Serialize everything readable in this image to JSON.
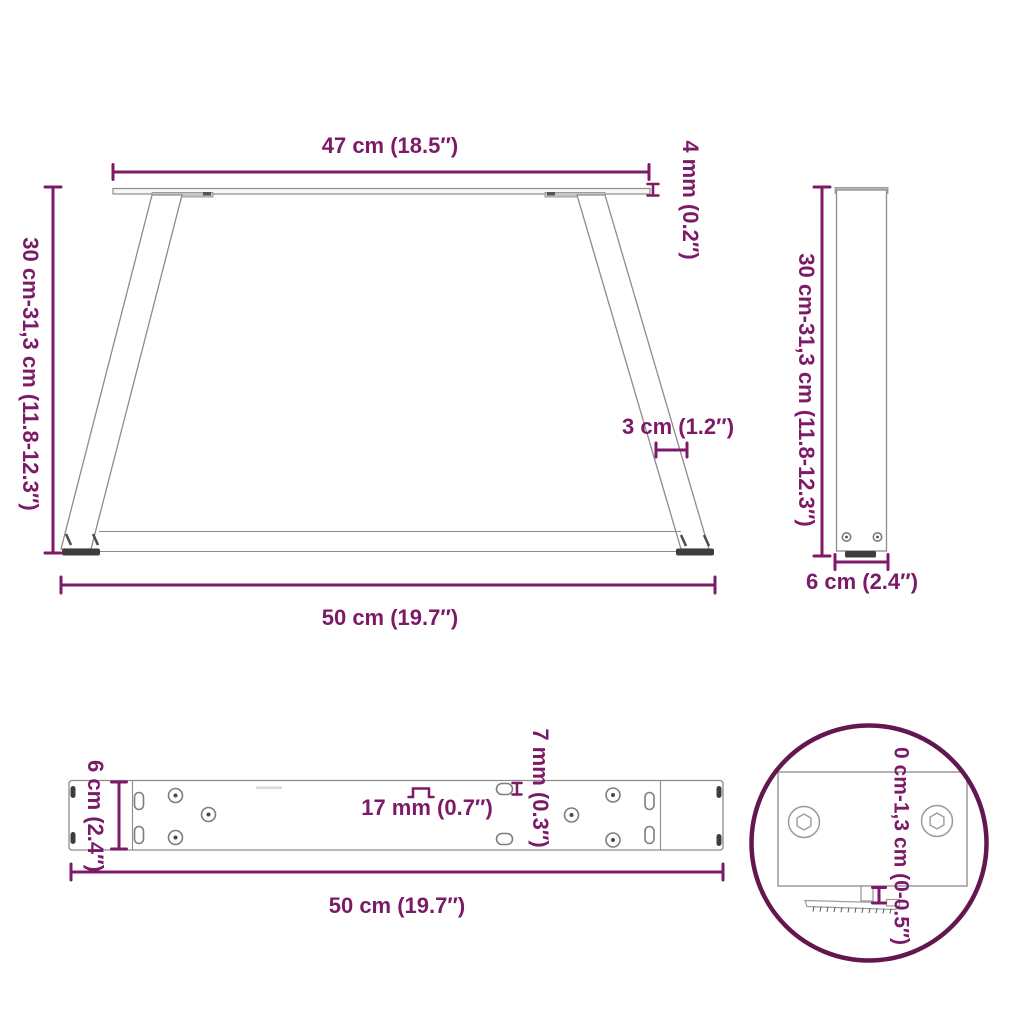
{
  "colors": {
    "accent": "#7D1A68",
    "detail_circle": "#64164F",
    "outline": "#8C8C8C",
    "dark": "#3D3D3D"
  },
  "views": {
    "front": {
      "labels": {
        "width_top": "47 cm (18.5″)",
        "thickness": "4 mm (0.2″)",
        "height": "30 cm-31,3 cm (11.8-12.3″)",
        "leg_width": "3 cm (1.2″)",
        "width_bottom": "50 cm (19.7″)"
      }
    },
    "side": {
      "labels": {
        "height": "30 cm-31,3 cm (11.8-12.3″)",
        "depth": "6 cm (2.4″)"
      }
    },
    "top": {
      "labels": {
        "depth": "6 cm (2.4″)",
        "slot_width": "17 mm (0.7″)",
        "slot_height": "7 mm (0.3″)",
        "length": "50 cm (19.7″)"
      }
    },
    "detail": {
      "labels": {
        "adjustment": "0 cm-1,3 cm (0-0.5″)"
      }
    }
  }
}
